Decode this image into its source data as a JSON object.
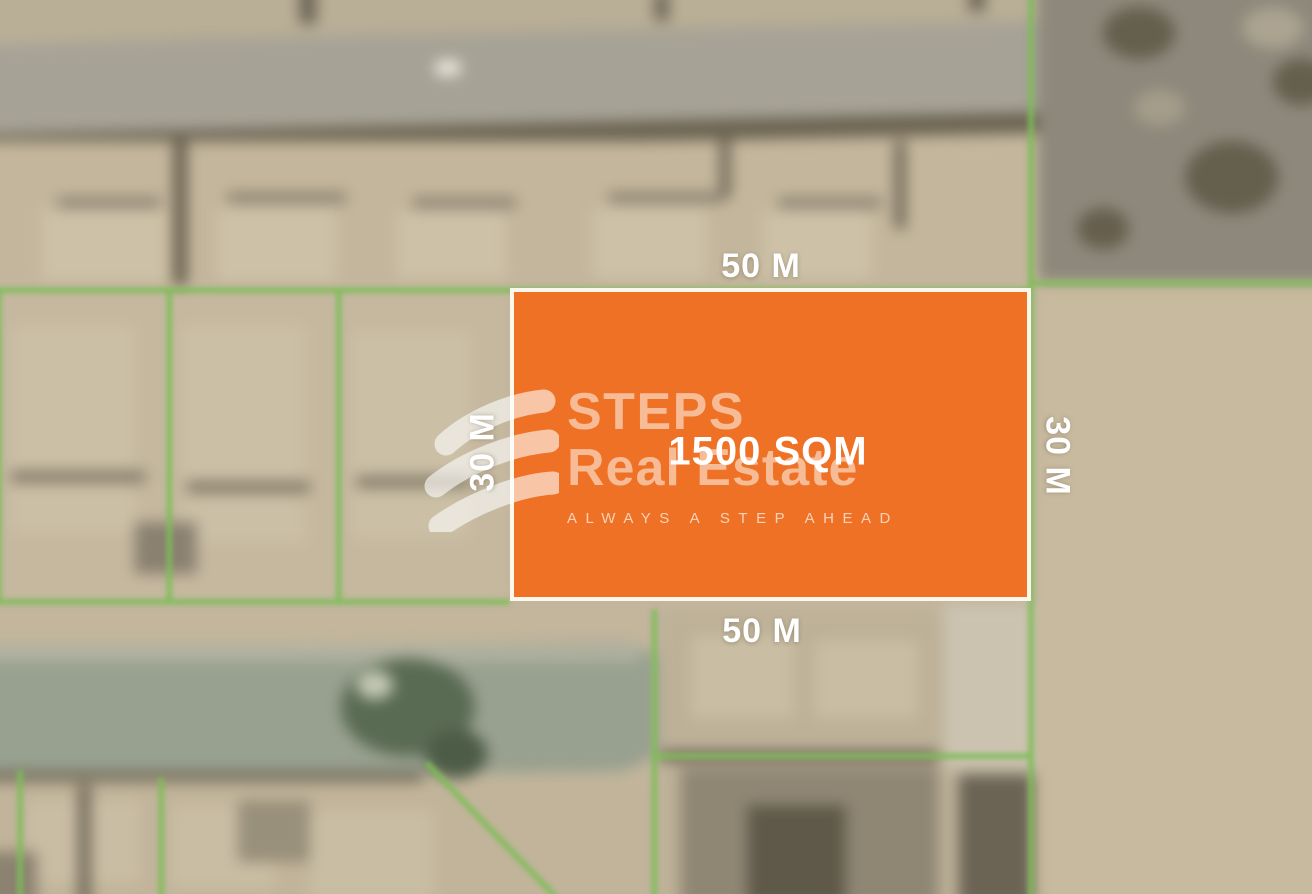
{
  "map_overlay": {
    "plot_size_label": "1500 SQM",
    "dimensions": {
      "top": "50 M",
      "bottom": "50 M",
      "left": "30 M",
      "right": "30 M"
    }
  },
  "watermark": {
    "brand_line1": "STEPS",
    "brand_line2": "Real Estate",
    "tagline": "ALWAYS A STEP AHEAD",
    "logo_icon": "steps-s-swoosh-icon"
  },
  "colors": {
    "plot_fill": "#EE7125",
    "plot_border": "#FBF7EC",
    "green": "#7EBD58",
    "label_text": "#FFFFFF",
    "sand": "#C3B69D"
  }
}
